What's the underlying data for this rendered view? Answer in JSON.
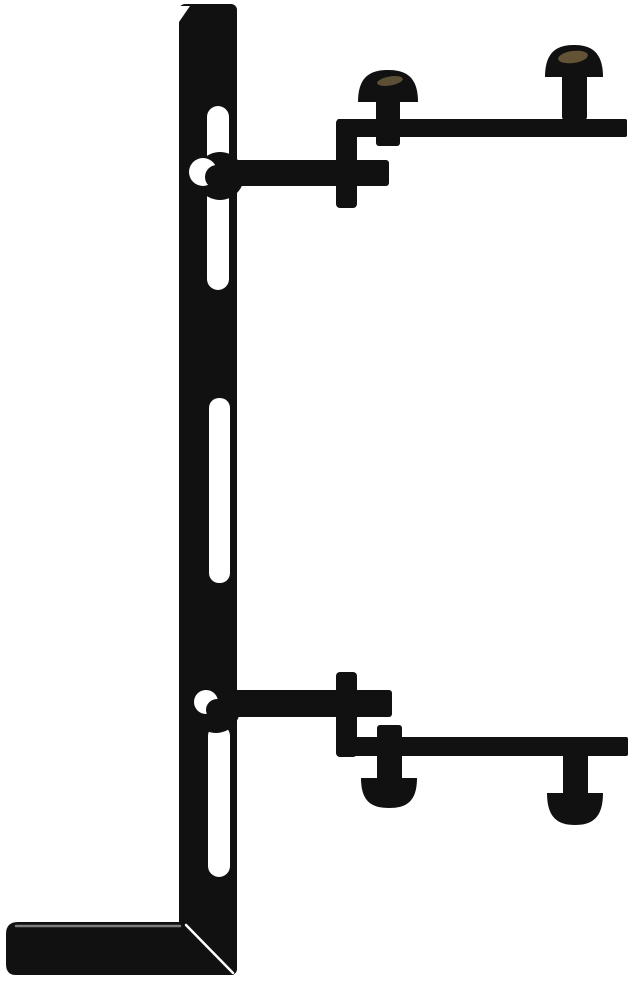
{
  "image": {
    "alt_text": "Side-profile product illustration of a black metal L-shaped mounting bracket: a slotted vertical column with an L foot at the bottom, an upper support arm bolted to the column leading to a stepped top rail with two upward mushroom-head screws, and a mirrored lower support arm leading to a bottom rail with two downward mushroom-head screws.",
    "background": "#ffffff"
  },
  "canvas": {
    "width": 634,
    "height": 986
  },
  "colors": {
    "ink": "#111111",
    "white": "#ffffff",
    "screw_sheen": "#6b5b3c",
    "edge_gray": "#7d7d7d"
  },
  "parts": [
    {
      "name": "bracket-column",
      "kind": "rect",
      "x": 179,
      "y": 4,
      "w": 58,
      "h": 971,
      "rx": 6,
      "fill": "ink"
    },
    {
      "name": "bracket-foot",
      "kind": "path",
      "d": "M18,922 L183,922 L234,975 L16,975 Q6,975 6,964 L6,934 Q6,922 18,922 Z",
      "fill": "ink"
    },
    {
      "name": "column-top-bevel-highlight",
      "kind": "path",
      "d": "M179,6 L190,6 L179,22 Z",
      "fill": "white"
    },
    {
      "name": "column-slot-top",
      "kind": "rect",
      "x": 207,
      "y": 106,
      "w": 22,
      "h": 184,
      "rx": 11,
      "fill": "white"
    },
    {
      "name": "column-slot-middle",
      "kind": "rect",
      "x": 209,
      "y": 398,
      "w": 21,
      "h": 185,
      "rx": 10,
      "fill": "white"
    },
    {
      "name": "column-slot-bottom",
      "kind": "rect",
      "x": 208,
      "y": 725,
      "w": 22,
      "h": 152,
      "rx": 11,
      "fill": "white"
    },
    {
      "name": "foot-top-edge-highlight",
      "kind": "line",
      "x1": 16,
      "y1": 926,
      "x2": 180,
      "y2": 926,
      "stroke": "edge_gray",
      "sw": 2.5
    },
    {
      "name": "foot-bevel-highlight",
      "kind": "line",
      "x1": 186,
      "y1": 925,
      "x2": 233,
      "y2": 973,
      "stroke": "white",
      "sw": 2.5
    },
    {
      "name": "upper-arm",
      "kind": "rect",
      "x": 234,
      "y": 160,
      "w": 155,
      "h": 26,
      "rx": 3,
      "fill": "ink"
    },
    {
      "name": "upper-clamp-tab",
      "kind": "rect",
      "x": 336,
      "y": 119,
      "w": 21,
      "h": 89,
      "rx": 4,
      "fill": "ink"
    },
    {
      "name": "top-rail",
      "kind": "rect",
      "x": 337,
      "y": 119,
      "w": 290,
      "h": 18,
      "rx": 2,
      "fill": "ink"
    },
    {
      "name": "top-screw-left-shank",
      "kind": "rect",
      "x": 376,
      "y": 96,
      "w": 24,
      "h": 50,
      "rx": 3,
      "fill": "ink"
    },
    {
      "name": "top-screw-left-head",
      "kind": "path",
      "d": "M358,102 C358,76 371,70 388,70 C405,70 418,76 418,102 Z",
      "fill": "ink"
    },
    {
      "name": "top-screw-left-sheen",
      "kind": "ellipse",
      "cx": 390,
      "cy": 81,
      "rx": 13,
      "ry": 4.5,
      "rot": -10,
      "fill": "screw_sheen",
      "opacity": 0.85
    },
    {
      "name": "top-screw-right-shank",
      "kind": "rect",
      "x": 562,
      "y": 72,
      "w": 25,
      "h": 48,
      "rx": 3,
      "fill": "ink"
    },
    {
      "name": "top-screw-right-head",
      "kind": "path",
      "d": "M545,77 C545,51 558,45 574,45 C590,45 603,51 603,77 Z",
      "fill": "ink"
    },
    {
      "name": "top-screw-right-sheen",
      "kind": "ellipse",
      "cx": 573,
      "cy": 57,
      "rx": 15,
      "ry": 6,
      "rot": -8,
      "fill": "screw_sheen",
      "opacity": 0.9
    },
    {
      "name": "upper-bolt",
      "kind": "circle",
      "cx": 220,
      "cy": 176,
      "r": 24,
      "fill": "ink"
    },
    {
      "name": "upper-bolt-highlight",
      "kind": "circle",
      "cx": 203,
      "cy": 172,
      "r": 14,
      "fill": "white"
    },
    {
      "name": "upper-bolt-core",
      "kind": "circle",
      "cx": 217,
      "cy": 177,
      "r": 12,
      "fill": "ink"
    },
    {
      "name": "lower-arm",
      "kind": "rect",
      "x": 234,
      "y": 690,
      "w": 158,
      "h": 27,
      "rx": 3,
      "fill": "ink"
    },
    {
      "name": "lower-clamp-tab",
      "kind": "rect",
      "x": 336,
      "y": 672,
      "w": 21,
      "h": 85,
      "rx": 4,
      "fill": "ink"
    },
    {
      "name": "bottom-rail",
      "kind": "rect",
      "x": 337,
      "y": 737,
      "w": 291,
      "h": 19,
      "rx": 2,
      "fill": "ink"
    },
    {
      "name": "bottom-screw-left-shank",
      "kind": "rect",
      "x": 377,
      "y": 725,
      "w": 25,
      "h": 57,
      "rx": 3,
      "fill": "ink"
    },
    {
      "name": "bottom-screw-left-head",
      "kind": "path",
      "d": "M361,778 C361,802 372,808 389,808 C406,808 417,802 417,778 Z",
      "fill": "ink"
    },
    {
      "name": "bottom-screw-right-shank",
      "kind": "rect",
      "x": 563,
      "y": 753,
      "w": 25,
      "h": 45,
      "rx": 3,
      "fill": "ink"
    },
    {
      "name": "bottom-screw-right-head",
      "kind": "path",
      "d": "M547,793 C547,818 558,825 575,825 C592,825 603,818 603,793 Z",
      "fill": "ink"
    },
    {
      "name": "lower-bolt",
      "kind": "circle",
      "cx": 216,
      "cy": 709,
      "r": 24,
      "fill": "ink"
    },
    {
      "name": "lower-bolt-highlight",
      "kind": "circle",
      "cx": 206,
      "cy": 702,
      "r": 12,
      "fill": "white"
    },
    {
      "name": "lower-bolt-core",
      "kind": "circle",
      "cx": 217,
      "cy": 710,
      "r": 11,
      "fill": "ink"
    }
  ]
}
